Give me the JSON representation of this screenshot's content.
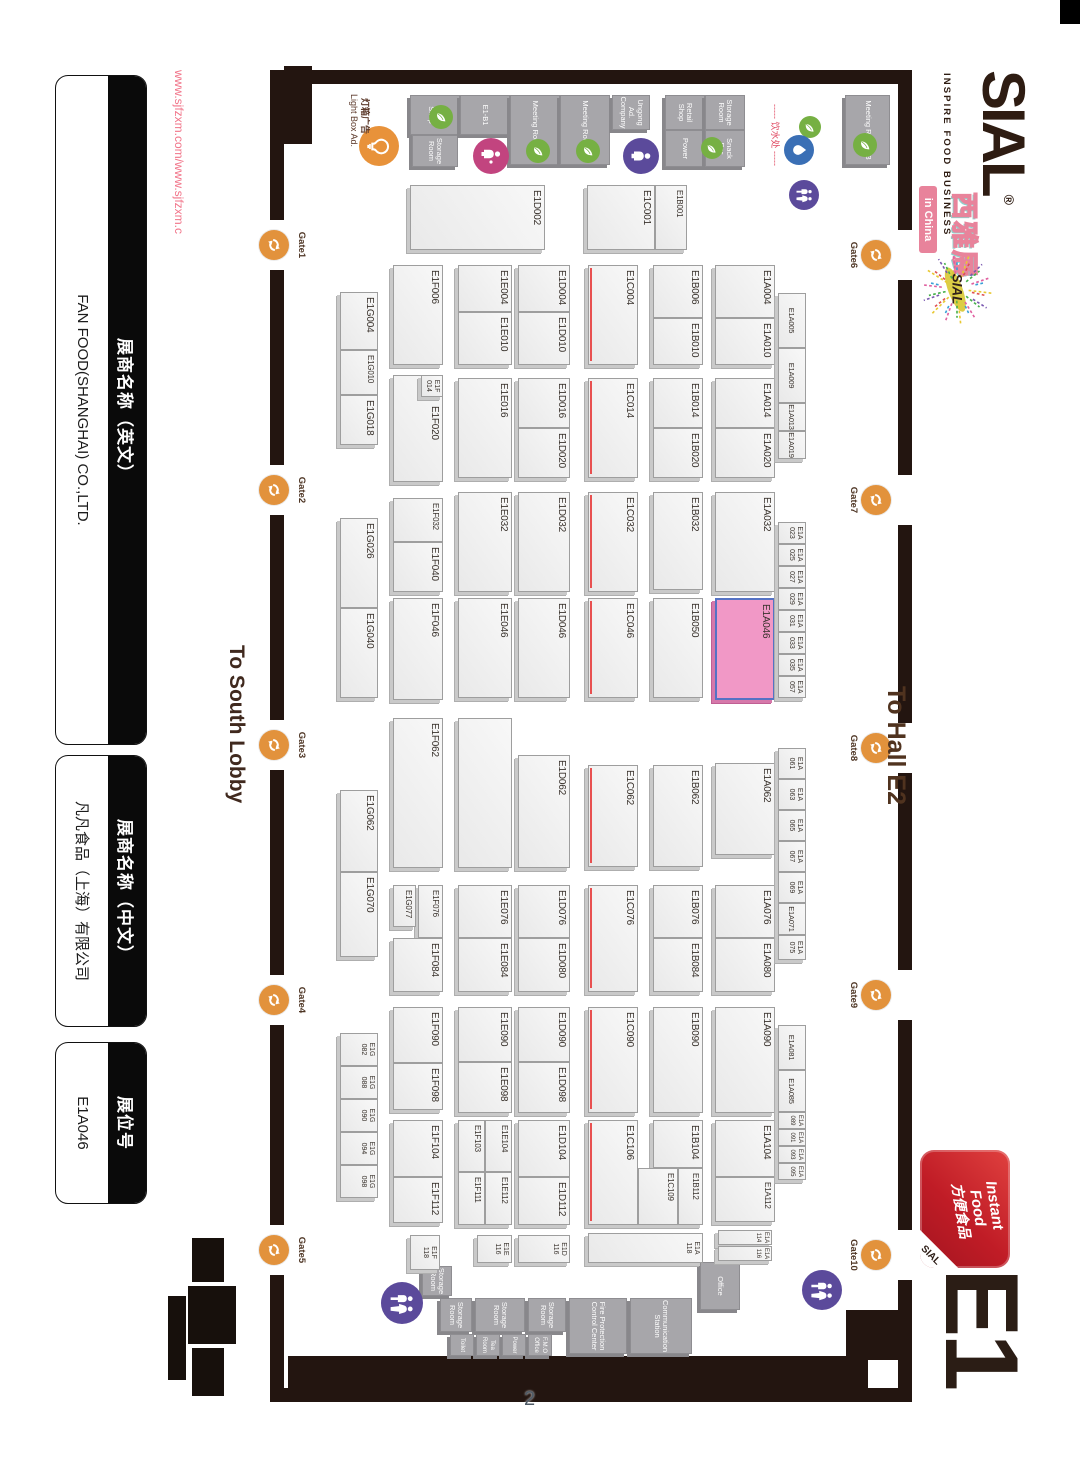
{
  "page": {
    "number": "2"
  },
  "watermark": "www.sjfzxm.com/www.sjfzxm.c",
  "panels": [
    {
      "title": "展商名称（英文）",
      "value": "FAN FOOD(SHANGHAI) CO.,LTD."
    },
    {
      "title": "展商名称（中文）",
      "value": "凡凡食品（上海）有限公司"
    },
    {
      "title": "展位号",
      "value": "E1A046"
    }
  ],
  "logo": {
    "name": "SIAL",
    "reg": "®",
    "tagline": "INSPIRE FOOD BUSINESS",
    "cn": "西雅展",
    "badge": "in China"
  },
  "hall": {
    "id": "E1",
    "badge": {
      "line1": "Instant",
      "line2": "Food",
      "cn": "方便食品",
      "brand": "SIAL"
    }
  },
  "colors": {
    "wall": "#231510",
    "booth_fill": "#efefef",
    "highlight_fill": "#f198c6",
    "highlight_border": "#5572c4",
    "accent_red": "#e85050",
    "gate_orange": "#e2923c",
    "leaf_green": "#76b043",
    "water_blue": "#3a6fb5",
    "person_pink": "#c2447f",
    "person_purple": "#5b4a9b",
    "badge_pink": "#e8839b",
    "instant_red": "#c01c26"
  },
  "map": {
    "booth_format": "[label, x, y, w, h, flags] flags: p=pink-highlight r=red-edge 2=two-line-label 1=centered s=small n=no-label d=offset-label",
    "booths": [
      [
        "E1A004",
        265,
        305,
        53,
        60,
        ""
      ],
      [
        "E1A010",
        318,
        305,
        47,
        60,
        ""
      ],
      [
        "E1A014",
        378,
        305,
        50,
        60,
        ""
      ],
      [
        "E1A020",
        428,
        305,
        50,
        60,
        ""
      ],
      [
        "E1A032",
        492,
        305,
        100,
        60,
        ""
      ],
      [
        "E1A046",
        598,
        305,
        102,
        60,
        "p"
      ],
      [
        "E1A062",
        763,
        305,
        92,
        60,
        ""
      ],
      [
        "E1A076",
        885,
        305,
        53,
        60,
        ""
      ],
      [
        "E1A080",
        938,
        305,
        54,
        60,
        ""
      ],
      [
        "E1A090",
        1007,
        305,
        106,
        60,
        ""
      ],
      [
        "E1A104",
        1120,
        305,
        57,
        60,
        ""
      ],
      [
        "E1A112",
        1177,
        305,
        45,
        60,
        ""
      ],
      [
        "E1A114",
        1230,
        308,
        15,
        54,
        "2"
      ],
      [
        "E1A116",
        1246,
        308,
        15,
        54,
        "2"
      ],
      [
        "E1B006",
        265,
        377,
        53,
        50,
        ""
      ],
      [
        "E1B010",
        318,
        377,
        47,
        50,
        ""
      ],
      [
        "E1B014",
        378,
        377,
        50,
        50,
        ""
      ],
      [
        "E1B020",
        428,
        377,
        50,
        50,
        ""
      ],
      [
        "E1B032",
        492,
        377,
        98,
        50,
        ""
      ],
      [
        "E1B050",
        598,
        377,
        100,
        50,
        ""
      ],
      [
        "E1B062",
        765,
        377,
        102,
        50,
        ""
      ],
      [
        "E1B076",
        885,
        377,
        53,
        50,
        ""
      ],
      [
        "E1B084",
        938,
        377,
        54,
        50,
        ""
      ],
      [
        "E1B090",
        1007,
        377,
        106,
        50,
        ""
      ],
      [
        "E1B104",
        1120,
        377,
        48,
        50,
        ""
      ],
      [
        "E1B112",
        1168,
        377,
        57,
        25,
        "s"
      ],
      [
        "E1C109",
        1168,
        402,
        57,
        40,
        "s"
      ],
      [
        "E1C004",
        265,
        442,
        100,
        50,
        "r"
      ],
      [
        "E1C014",
        378,
        442,
        100,
        50,
        "r"
      ],
      [
        "E1C032",
        492,
        442,
        100,
        50,
        "r"
      ],
      [
        "E1C046",
        598,
        442,
        100,
        50,
        "r"
      ],
      [
        "E1C062",
        765,
        442,
        102,
        50,
        "r"
      ],
      [
        "E1C076",
        885,
        442,
        107,
        50,
        "r"
      ],
      [
        "E1C090",
        1007,
        442,
        106,
        50,
        "r"
      ],
      [
        "E1C106",
        1120,
        442,
        105,
        50,
        "r"
      ],
      [
        "E1A118",
        1233,
        377,
        30,
        115,
        "2"
      ],
      [
        "E1D002",
        185,
        535,
        65,
        135,
        ""
      ],
      [
        "E1B001",
        185,
        393,
        65,
        32,
        "s"
      ],
      [
        "E1C001",
        185,
        425,
        65,
        68,
        ""
      ],
      [
        "E1D004",
        265,
        510,
        47,
        52,
        ""
      ],
      [
        "E1D010",
        312,
        510,
        53,
        52,
        ""
      ],
      [
        "E1D016",
        378,
        510,
        50,
        52,
        ""
      ],
      [
        "E1D020",
        428,
        510,
        50,
        52,
        ""
      ],
      [
        "E1D032",
        492,
        510,
        100,
        52,
        ""
      ],
      [
        "E1D046",
        598,
        510,
        100,
        52,
        ""
      ],
      [
        "E1D062",
        755,
        510,
        113,
        52,
        ""
      ],
      [
        "E1D076",
        885,
        510,
        53,
        52,
        ""
      ],
      [
        "E1D080",
        938,
        510,
        54,
        52,
        ""
      ],
      [
        "E1D090",
        1007,
        510,
        55,
        52,
        ""
      ],
      [
        "E1D098",
        1062,
        510,
        51,
        52,
        ""
      ],
      [
        "E1D104",
        1120,
        510,
        57,
        52,
        ""
      ],
      [
        "E1D112",
        1177,
        510,
        48,
        52,
        ""
      ],
      [
        "E1D116",
        1235,
        510,
        28,
        52,
        "2"
      ],
      [
        "E1E004",
        265,
        568,
        47,
        54,
        ""
      ],
      [
        "E1E010",
        312,
        568,
        53,
        54,
        ""
      ],
      [
        "E1E016",
        378,
        568,
        100,
        54,
        ""
      ],
      [
        "E1E032",
        492,
        568,
        100,
        54,
        ""
      ],
      [
        "E1E046",
        598,
        568,
        100,
        54,
        ""
      ],
      [
        "",
        718,
        568,
        150,
        54,
        "n"
      ],
      [
        "E1E076",
        885,
        568,
        53,
        54,
        ""
      ],
      [
        "E1E084",
        938,
        568,
        54,
        54,
        ""
      ],
      [
        "E1E090",
        1007,
        568,
        55,
        54,
        ""
      ],
      [
        "E1E098",
        1062,
        568,
        51,
        54,
        ""
      ],
      [
        "E1E104",
        1120,
        568,
        52,
        27,
        "s"
      ],
      [
        "E1F103",
        1120,
        595,
        52,
        27,
        "s"
      ],
      [
        "E1E112",
        1172,
        568,
        53,
        27,
        "s"
      ],
      [
        "E1F111",
        1172,
        595,
        53,
        27,
        "s"
      ],
      [
        "E1E116",
        1235,
        568,
        28,
        35,
        "2"
      ],
      [
        "E1F006",
        265,
        637,
        100,
        50,
        ""
      ],
      [
        "E1F020",
        375,
        637,
        107,
        50,
        "d"
      ],
      [
        "E1F014",
        375,
        637,
        22,
        22,
        "2"
      ],
      [
        "E1F032",
        498,
        637,
        44,
        50,
        ""
      ],
      [
        "E1F040",
        542,
        637,
        50,
        50,
        ""
      ],
      [
        "E1F046",
        598,
        637,
        102,
        50,
        ""
      ],
      [
        "E1F062",
        718,
        637,
        150,
        50,
        ""
      ],
      [
        "E1F076",
        885,
        637,
        53,
        25,
        "s"
      ],
      [
        "E1G077",
        885,
        664,
        42,
        23,
        "s"
      ],
      [
        "E1F084",
        938,
        637,
        54,
        50,
        ""
      ],
      [
        "E1F090",
        1007,
        637,
        56,
        50,
        ""
      ],
      [
        "E1F098",
        1063,
        637,
        47,
        50,
        ""
      ],
      [
        "E1F104",
        1120,
        637,
        57,
        50,
        ""
      ],
      [
        "E1F112",
        1177,
        637,
        46,
        50,
        ""
      ],
      [
        "E1F118",
        1235,
        640,
        35,
        30,
        "2"
      ],
      [
        "E1G004",
        292,
        702,
        58,
        38,
        ""
      ],
      [
        "E1G010",
        350,
        702,
        45,
        38,
        ""
      ],
      [
        "E1G018",
        395,
        702,
        50,
        38,
        ""
      ],
      [
        "E1G026",
        518,
        702,
        90,
        38,
        ""
      ],
      [
        "E1G040",
        608,
        702,
        90,
        38,
        ""
      ],
      [
        "E1G062",
        790,
        702,
        82,
        38,
        ""
      ],
      [
        "E1G070",
        872,
        702,
        85,
        38,
        ""
      ],
      [
        "E1G082",
        1033,
        702,
        33,
        38,
        "2"
      ],
      [
        "E1G088",
        1066,
        702,
        33,
        38,
        "2"
      ],
      [
        "E1G090",
        1099,
        702,
        33,
        38,
        "2"
      ],
      [
        "E1G094",
        1132,
        702,
        33,
        38,
        "2"
      ],
      [
        "E1G098",
        1165,
        702,
        33,
        38,
        "2"
      ],
      [
        "E1A005",
        293,
        274,
        55,
        28,
        "1"
      ],
      [
        "E1A009",
        348,
        274,
        55,
        28,
        "1"
      ],
      [
        "E1A013",
        403,
        274,
        28,
        28,
        "1s"
      ],
      [
        "E1A019",
        431,
        274,
        28,
        28,
        "1s"
      ],
      [
        "E1A023",
        522,
        274,
        22,
        28,
        "2"
      ],
      [
        "E1A025",
        544,
        274,
        22,
        28,
        "2"
      ],
      [
        "E1A027",
        566,
        274,
        22,
        28,
        "2"
      ],
      [
        "E1A029",
        588,
        274,
        22,
        28,
        "2"
      ],
      [
        "E1A031",
        610,
        274,
        22,
        28,
        "2"
      ],
      [
        "E1A033",
        632,
        274,
        22,
        28,
        "2"
      ],
      [
        "E1A035",
        654,
        274,
        22,
        28,
        "2"
      ],
      [
        "E1A057",
        676,
        274,
        22,
        28,
        "2"
      ],
      [
        "E1A061",
        748,
        274,
        31,
        28,
        "2"
      ],
      [
        "E1A063",
        779,
        274,
        31,
        28,
        "2"
      ],
      [
        "E1A065",
        810,
        274,
        31,
        28,
        "2"
      ],
      [
        "E1A067",
        841,
        274,
        31,
        28,
        "2"
      ],
      [
        "E1A069",
        872,
        274,
        31,
        28,
        "2"
      ],
      [
        "E1A071",
        903,
        274,
        32,
        28,
        "1s"
      ],
      [
        "E1A075",
        935,
        274,
        25,
        28,
        "2"
      ],
      [
        "E1A081",
        1025,
        274,
        45,
        28,
        "1"
      ],
      [
        "E1A085",
        1070,
        274,
        42,
        28,
        "1"
      ],
      [
        "E1A089",
        1112,
        274,
        17,
        28,
        "2"
      ],
      [
        "E1A091",
        1129,
        274,
        17,
        28,
        "2"
      ],
      [
        "E1A093",
        1146,
        274,
        17,
        28,
        "2"
      ],
      [
        "E1A095",
        1163,
        274,
        17,
        28,
        "2"
      ]
    ],
    "rooms": [
      [
        "Retail Shop",
        95,
        620,
        40,
        50
      ],
      [
        "Storage Room",
        135,
        622,
        32,
        46
      ],
      [
        "E1-B1",
        95,
        570,
        40,
        50
      ],
      [
        "Meeting Room 11",
        95,
        520,
        70,
        50
      ],
      [
        "Meeting Room 12",
        95,
        470,
        70,
        50
      ],
      [
        "Ungong Ad. Company",
        95,
        430,
        35,
        38
      ],
      [
        "Retail Shop",
        95,
        375,
        35,
        40
      ],
      [
        "Power",
        130,
        375,
        37,
        40
      ],
      [
        "Storage Room",
        95,
        335,
        35,
        40
      ],
      [
        "Snack Bar",
        130,
        335,
        37,
        40
      ],
      [
        "Meeting Room 13",
        95,
        190,
        70,
        45
      ],
      [
        "Office",
        1262,
        340,
        48,
        40
      ],
      [
        "Communication Station",
        1298,
        388,
        56,
        62
      ],
      [
        "Fire Protection Control Center",
        1298,
        453,
        56,
        58
      ],
      [
        "Storage Room",
        1298,
        514,
        34,
        38
      ],
      [
        "Storage Room",
        1298,
        555,
        34,
        50
      ],
      [
        "Storage Room",
        1298,
        608,
        34,
        32
      ],
      [
        "F.M.O Office",
        1334,
        528,
        22,
        24
      ],
      [
        "Power",
        1334,
        554,
        22,
        24
      ],
      [
        "Tea Room",
        1334,
        580,
        22,
        24
      ],
      [
        "Toilet",
        1334,
        606,
        22,
        24
      ],
      [
        "Storage Room",
        1266,
        628,
        30,
        30
      ]
    ],
    "walls": [
      [
        70,
        168,
        160,
        14
      ],
      [
        280,
        168,
        195,
        14
      ],
      [
        525,
        168,
        198,
        14
      ],
      [
        773,
        168,
        197,
        14
      ],
      [
        1020,
        168,
        210,
        14
      ],
      [
        1280,
        168,
        122,
        14
      ],
      [
        70,
        796,
        150,
        14
      ],
      [
        270,
        796,
        195,
        14
      ],
      [
        515,
        796,
        205,
        14
      ],
      [
        770,
        796,
        205,
        14
      ],
      [
        1025,
        796,
        200,
        14
      ],
      [
        1275,
        796,
        127,
        14
      ],
      [
        70,
        168,
        14,
        642
      ],
      [
        1356,
        212,
        46,
        580
      ],
      [
        1388,
        168,
        14,
        56
      ],
      [
        1388,
        778,
        14,
        32
      ],
      [
        66,
        768,
        78,
        28
      ],
      [
        1310,
        182,
        50,
        52
      ]
    ],
    "black_shapes": [
      [
        1238,
        856,
        44,
        32
      ],
      [
        1286,
        844,
        58,
        48
      ],
      [
        1348,
        856,
        48,
        32
      ],
      [
        1296,
        894,
        84,
        18
      ]
    ],
    "gates_top": [
      [
        "Gate6",
        255
      ],
      [
        "Gate7",
        500
      ],
      [
        "Gate8",
        748
      ],
      [
        "Gate9",
        995
      ],
      [
        "Gate10",
        1255
      ]
    ],
    "gates_bottom": [
      [
        "Gate1",
        245
      ],
      [
        "Gate2",
        490
      ],
      [
        "Gate3",
        745
      ],
      [
        "Gate4",
        1000
      ],
      [
        "Gate5",
        1250
      ]
    ],
    "icons": [
      [
        "leaf",
        117,
        639,
        24
      ],
      [
        "leaf",
        151,
        542,
        24
      ],
      [
        "leaf",
        151,
        492,
        24
      ],
      [
        "leaf",
        148,
        368,
        22
      ],
      [
        "leaf",
        145,
        215,
        24
      ],
      [
        "leaf",
        127,
        270,
        22
      ],
      [
        "drop",
        150,
        281,
        30
      ],
      [
        "bulb",
        146,
        701,
        40
      ],
      [
        "entrance",
        156,
        589,
        36
      ],
      [
        "visitor",
        156,
        439,
        36
      ],
      [
        "restroom",
        195,
        276,
        30
      ],
      [
        "restroom",
        1303,
        678,
        42
      ],
      [
        "restroom",
        1290,
        258,
        40
      ]
    ],
    "notes": [
      [
        "To South Lobby",
        645,
        832,
        21,
        "#40291e",
        700,
        "direction-south-lobby"
      ],
      [
        "To Hall E2",
        686,
        170,
        25,
        "#50331f",
        700,
        "direction-hall-e2"
      ],
      [
        "----- 饮水处 -----",
        104,
        298,
        9,
        "#e04b63",
        400,
        "drinking-water-label"
      ],
      [
        "灯箱广告",
        98,
        708,
        9,
        "#5c392a",
        700,
        "ad-note-cn"
      ],
      [
        "Light Box Ad.",
        94,
        721,
        9,
        "#5c392a",
        400,
        "ad-note-en"
      ]
    ]
  }
}
